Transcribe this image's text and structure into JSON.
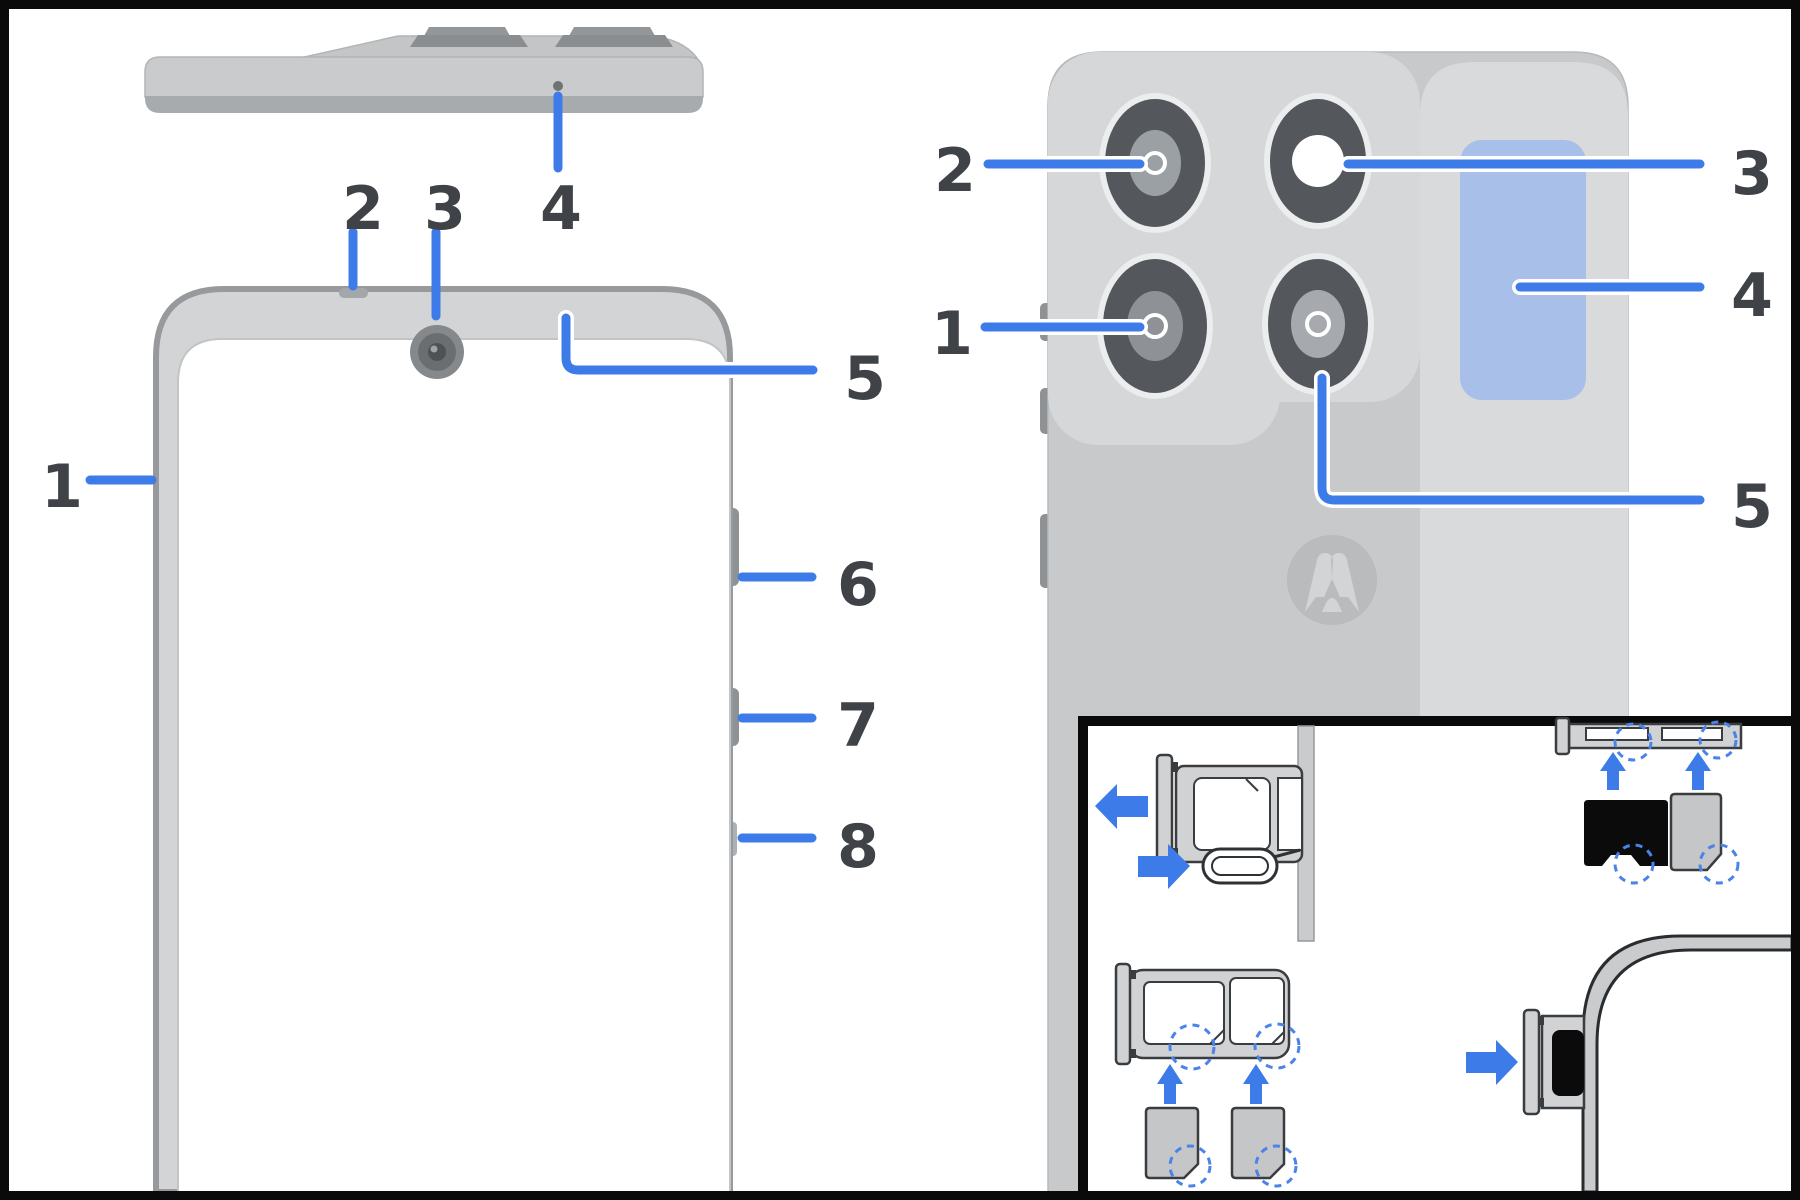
{
  "page": {
    "type": "device-hardware-diagram",
    "background": "#ffffff",
    "frame_color": "#0a0a0a"
  },
  "colors": {
    "callout_blue": "#3d7ce8",
    "label_gray": "#3f4347",
    "phone_body_gray": "#c8cacc",
    "camera_module_gray": "#d6d7d9",
    "side_panel_gray": "#d9dadc",
    "camera_lens_dark": "#54585c",
    "highlight_panel_blue": "#a7bfe9",
    "dashed_circle_blue": "#4b83e8",
    "sim_tray_fill": "#d0d2d4",
    "sim_card_fill": "#c4c6c8",
    "microsd_black": "#0b0b0c"
  },
  "front_view": {
    "title": "phone front, top edge and side buttons",
    "callouts": [
      {
        "label": "1",
        "points_to": "screen-left-edge"
      },
      {
        "label": "2",
        "points_to": "earpiece-notch"
      },
      {
        "label": "3",
        "points_to": "front-camera"
      },
      {
        "label": "4",
        "points_to": "top-edge-mic-hole"
      },
      {
        "label": "5",
        "points_to": "top-bezel-right-area"
      },
      {
        "label": "6",
        "points_to": "volume-button"
      },
      {
        "label": "7",
        "points_to": "power-button"
      },
      {
        "label": "8",
        "points_to": "right-edge-lower-slot"
      }
    ]
  },
  "back_view": {
    "title": "phone back with quad camera array",
    "callouts": [
      {
        "label": "1",
        "points_to": "camera-bottom-left"
      },
      {
        "label": "2",
        "points_to": "camera-top-left"
      },
      {
        "label": "3",
        "points_to": "camera-top-right-flash"
      },
      {
        "label": "4",
        "points_to": "blue-highlight-panel"
      },
      {
        "label": "5",
        "points_to": "camera-bottom-right"
      }
    ],
    "logo": "motorola-m-logo"
  },
  "sim_inset": {
    "panels": [
      "sim-tray-eject-left-arrow",
      "sim-ejector-tool-push-arrow",
      "dual-sim-tray-with-two-nano-sims",
      "microsd-and-nano-sim-into-edge-tray",
      "tray-insert-into-phone-corner"
    ]
  }
}
